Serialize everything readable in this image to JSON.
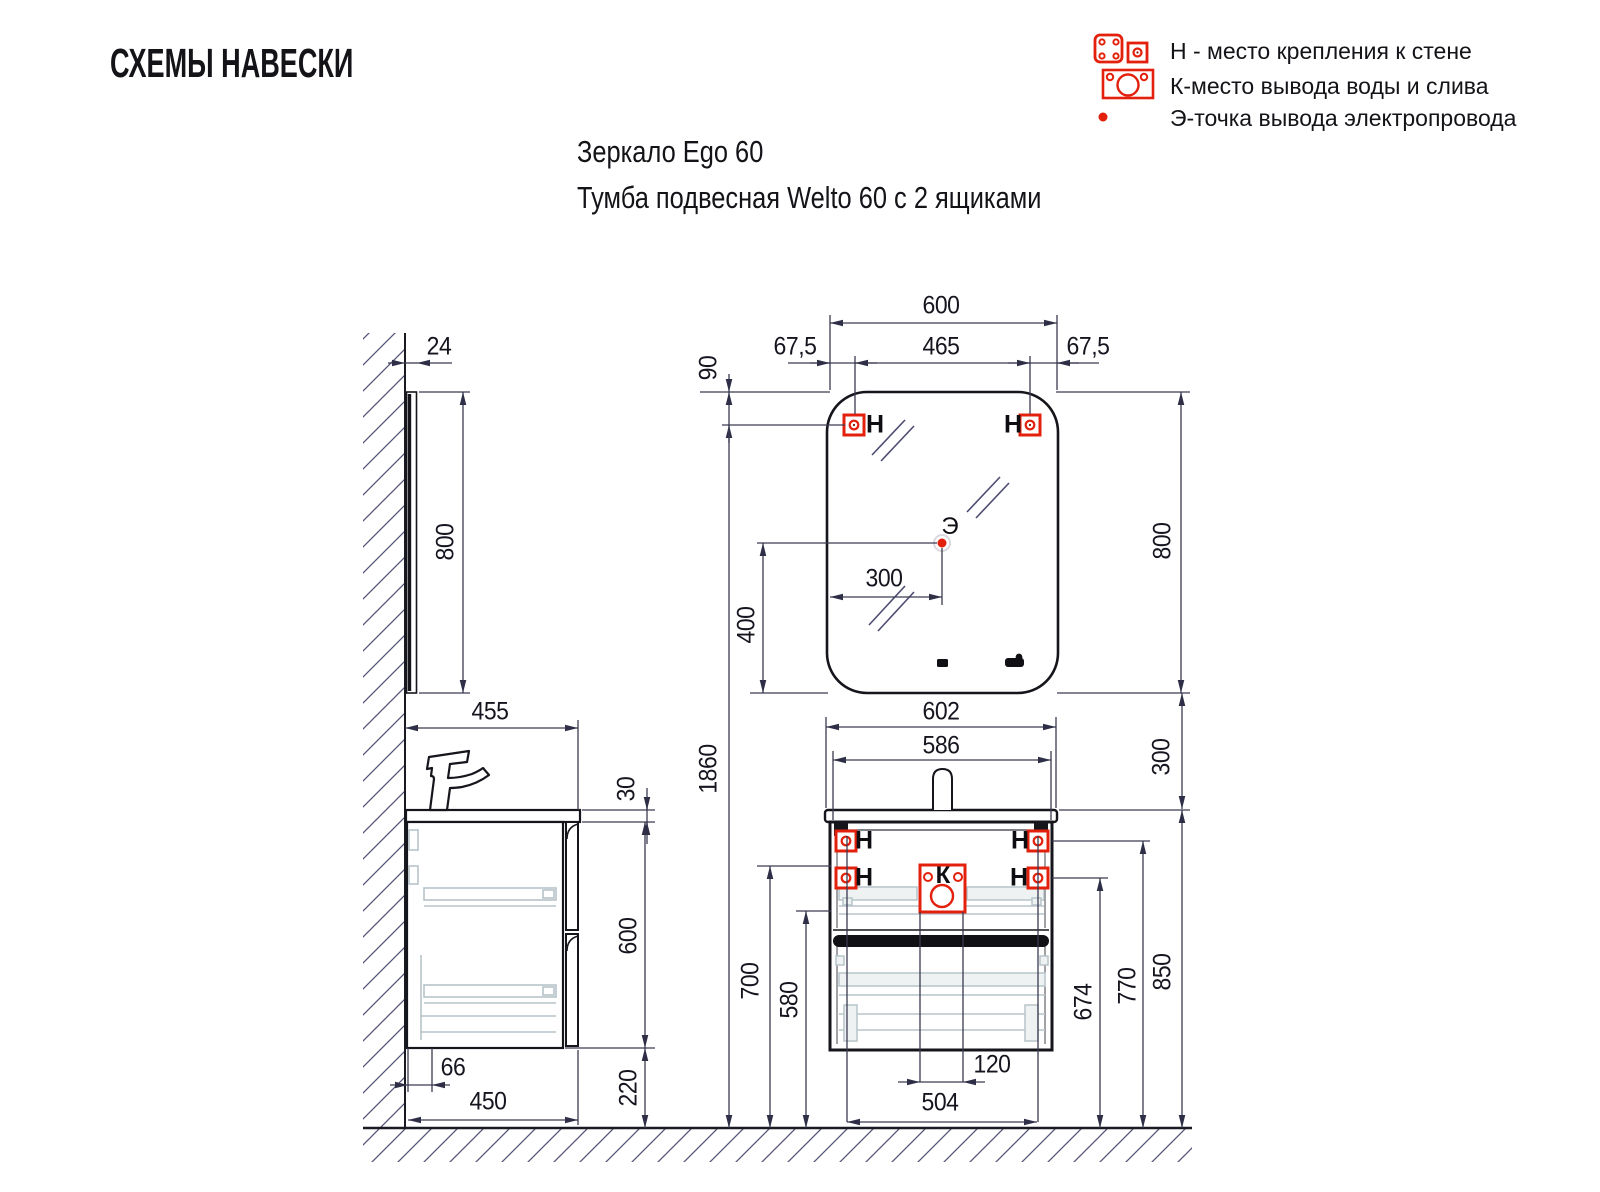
{
  "header": {
    "title": "СХЕМЫ НАВЕСКИ",
    "subtitle_line1": "Зеркало Ego 60",
    "subtitle_line2": "Тумба подвесная Welto 60 с 2 ящиками"
  },
  "legend": {
    "items": [
      {
        "icon": "wall-mount-icon",
        "label": "Н - место крепления к стене"
      },
      {
        "icon": "water-drain-icon",
        "label": "К-место вывода воды и слива"
      },
      {
        "icon": "electric-point-icon",
        "label": "Э-точка вывода электропровода"
      }
    ]
  },
  "markers": {
    "wall_mount_letter": "Н",
    "water_letter": "К",
    "electric_letter": "Э"
  },
  "dim_labels": {
    "side_mirror_offset": "24",
    "side_mirror_height": "800",
    "side_counter_depth": "455",
    "side_counter_thickness": "30",
    "side_cabinet_height": "600",
    "side_bottom_inset": "66",
    "side_cabinet_depth": "450",
    "side_floor_gap": "220",
    "total_height": "1860",
    "mirror_mount_offset_top": "90",
    "mirror_width": "600",
    "mirror_mount_left": "67,5",
    "mirror_mount_span": "465",
    "mirror_mount_right": "67,5",
    "mirror_height": "800",
    "electric_offset_x": "300",
    "electric_offset_y": "400",
    "counter_width": "602",
    "cabinet_width": "586",
    "mirror_to_counter": "300",
    "floor_to_mount_mid": "700",
    "floor_to_drawer_top": "580",
    "drain_offset": "120",
    "cabinet_mount_span": "504",
    "floor_to_mount_lower": "674",
    "floor_to_mount_upper": "770",
    "floor_to_counter_top": "850"
  },
  "colors": {
    "accent_red": "#e3200c",
    "line_dark": "#15151c",
    "dim_line": "#3a3a52",
    "hatch": "#55557a",
    "hardware_light": "#b7c4c9"
  }
}
